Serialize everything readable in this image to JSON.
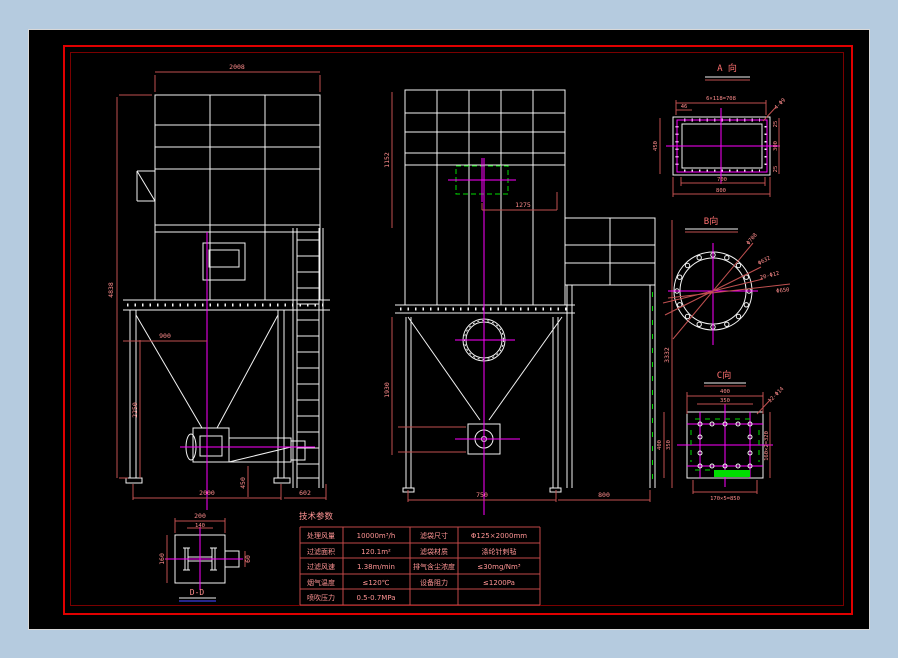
{
  "drawing": {
    "table": {
      "title": "技术参数",
      "rows": [
        [
          "处理风量",
          "10000m³/h",
          "滤袋尺寸",
          "Φ125×2000mm"
        ],
        [
          "过滤面积",
          "120.1m²",
          "滤袋材质",
          "涤纶针刺毡"
        ],
        [
          "过滤风速",
          "1.38m/min",
          "排气含尘浓度",
          "≤30mg/Nm³"
        ],
        [
          "烟气温度",
          "≤120℃",
          "设备阻力",
          "≤1200Pa"
        ],
        [
          "喷吹压力",
          "0.5-0.7MPa",
          "",
          ""
        ]
      ]
    },
    "left_view": {
      "dims": {
        "top_width": "2008",
        "height_total": "4838",
        "hopper_width": "900",
        "hopper_height": "2250",
        "valve_height": "450",
        "bottom_width": "2000",
        "ladder_offset": "602"
      }
    },
    "front_view": {
      "dims": {
        "inlet_offset": "1275",
        "upper_height": "1152",
        "lower_height": "1930",
        "right_height": "3332",
        "bottom_width": "750",
        "support_width": "800"
      }
    },
    "detail_a": {
      "title": "A 向",
      "dims": {
        "edge": "46",
        "pitch": "6×118=708",
        "holes": "4-Φ9",
        "left": "450",
        "right_top": "25",
        "right_mid": "300",
        "right_bottom": "25",
        "bottom_inner": "700",
        "bottom_outer": "800"
      }
    },
    "detail_b": {
      "title": "B向",
      "labels": {
        "outer_dia": "Φ708",
        "inner_dia": "Φ632",
        "holes": "20-Φ12",
        "bolt_circle": "Φ650"
      }
    },
    "detail_c": {
      "title": "C向",
      "dims": {
        "top_outer": "400",
        "top_inner": "350",
        "holes": "12-Φ14",
        "left_outer": "400",
        "left_inner": "350",
        "right": "160×2=320",
        "bottom": "170×5=850"
      }
    },
    "detail_d": {
      "title": "D-D",
      "dims": {
        "top": "200",
        "inner": "140",
        "left": "160",
        "right": "60"
      }
    },
    "colors": {
      "background": "#b5cbdf",
      "canvas": "#000000",
      "frame": "#e00000",
      "inner_frame": "#7a0000",
      "geometry": "#f2f2f2",
      "centerline": "#ff00ff",
      "dimension": "#c05050",
      "highlight": "#00dd00"
    }
  }
}
